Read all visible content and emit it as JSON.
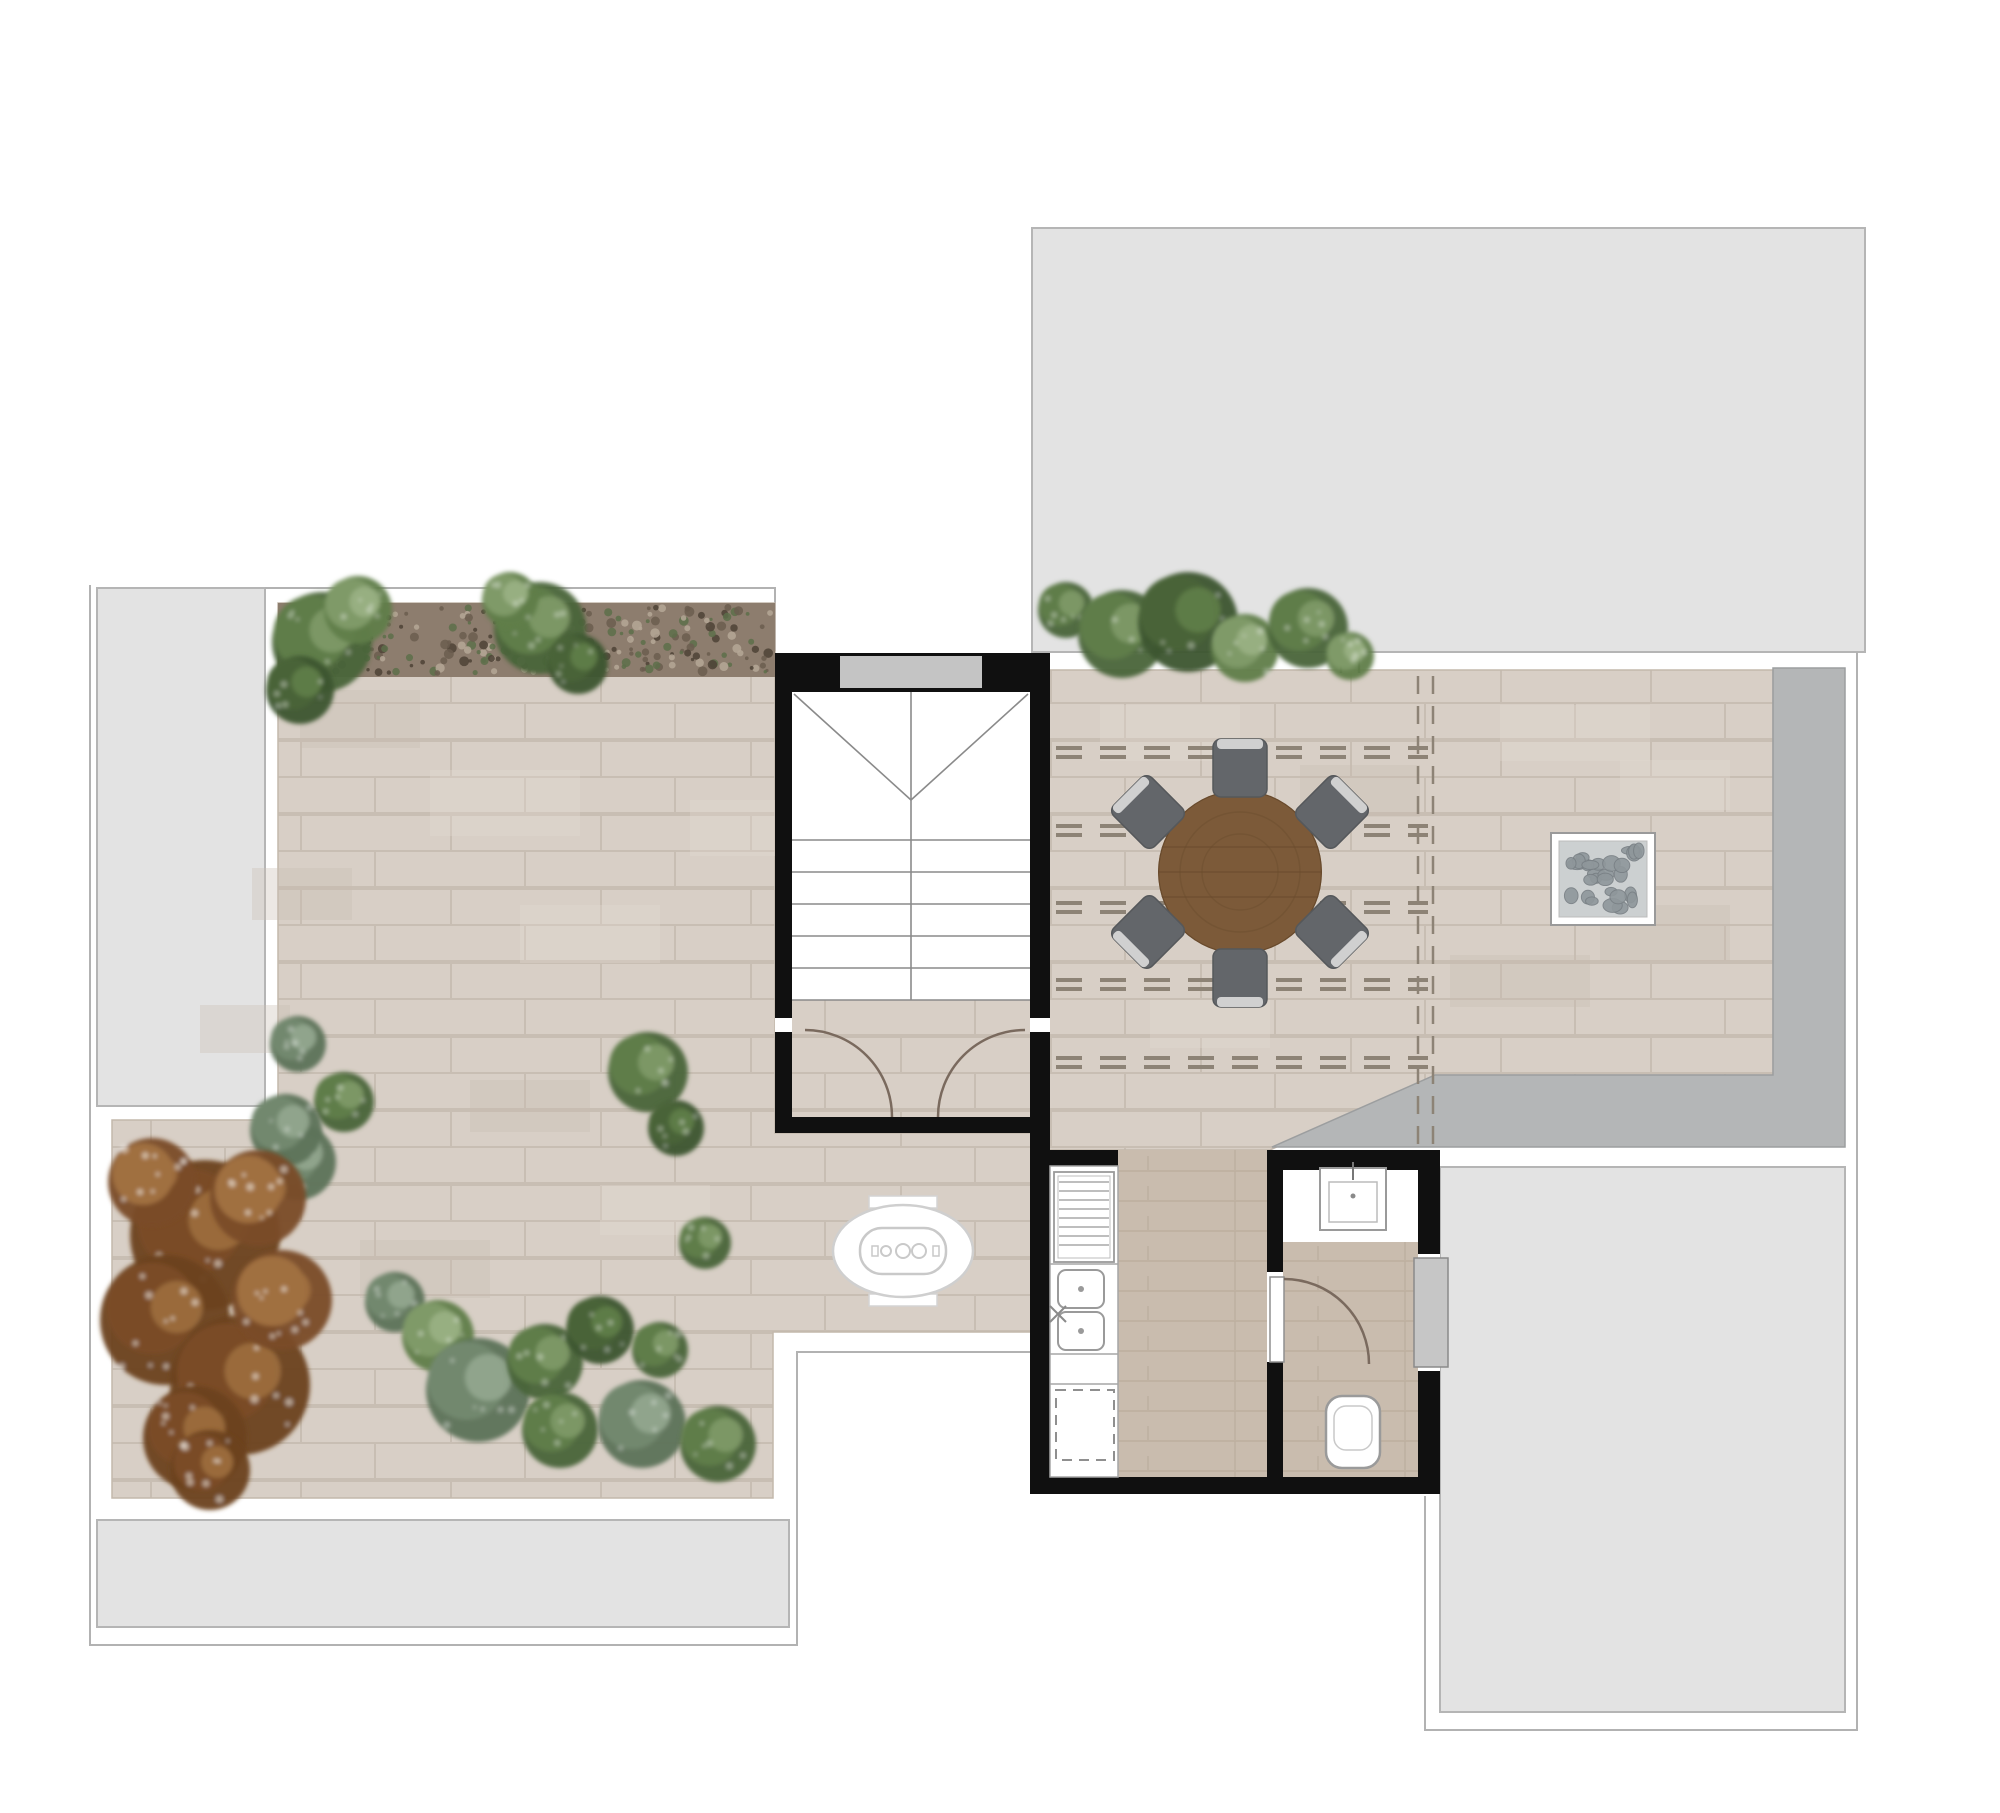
{
  "plan": {
    "kind": "rooftop-terrace-floor-plan",
    "width": 2000,
    "height": 1813,
    "rooms": [
      "left-terrace",
      "dining-terrace",
      "stairwell",
      "kitchen",
      "bathroom"
    ],
    "adjacent_roofs": [
      "roof-top-right",
      "roof-left",
      "roof-bottom-left",
      "roof-bottom-right"
    ]
  },
  "palette": {
    "page_bg": "#ffffff",
    "roof_gray": "#e3e3e3",
    "roof_border": "#b5b5b5",
    "outline": "#b2b2b2",
    "band_gray": "#b4b6b7",
    "band_border": "#9c9e9f",
    "paving": "#d8cfc6",
    "paving_joint": "#c3b8ac",
    "paving_light": "#e2dad2",
    "paving_dark": "#c9beb2",
    "interior_floor": "#c9bcae",
    "plank_line": "#b7a796",
    "wall_black": "#101010",
    "elevator_gray": "#c4c4c4",
    "stair_line": "#8a8a8a",
    "door_line": "#7a6a5e",
    "fixture_border": "#9a9a9a",
    "fixture_inner": "#bcbcbc",
    "window_gray": "#c6c6c6",
    "gravel_base": "#8d7d6e",
    "gravel_dark": "#4e4236",
    "gravel_light": "#b5a797",
    "gravel_green": "#5d6f4a",
    "pergola_dash": "#8d8376",
    "table_wood": "#7c5a39",
    "table_wood_dark": "#684a2c",
    "chair_gray": "#63666a",
    "chair_edge": "#55585b",
    "chair_light": "#d9d9d9",
    "pebble_bg": "#ccd0d1",
    "pebble": "#8f979b",
    "pebble_edge": "#798085",
    "bush_g": "#5f7d48",
    "bush_gd": "#4a6438",
    "bush_gl": "#7f9a68",
    "bush_sage": "#72886e",
    "tree_b": "#7a4c27",
    "tree_bl": "#a0703f"
  },
  "roofs": [
    {
      "name": "roof-top-right",
      "x": 1032,
      "y": 228,
      "w": 833,
      "h": 424
    },
    {
      "name": "roof-left",
      "x": 97,
      "y": 588,
      "w": 168,
      "h": 518
    },
    {
      "name": "roof-bottom-left",
      "x": 97,
      "y": 1520,
      "w": 692,
      "h": 107
    },
    {
      "name": "roof-bottom-right",
      "x": 1440,
      "y": 1167,
      "w": 405,
      "h": 545
    }
  ],
  "outlines": [
    {
      "name": "parapet-outline-top-left",
      "d": "M265,588 H775 V651"
    },
    {
      "name": "parapet-outline-lower-left",
      "d": "M90,585 V1645 H797 V1352 H1030"
    },
    {
      "name": "parapet-outline-right",
      "d": "M1857,652 V1730 H1425 V1496"
    }
  ],
  "paving": {
    "left_terrace_points": "278,603 775,603 775,1133 1032,1133 1032,1332 773,1332 773,1498 112,1498 112,1120 278,1120",
    "dining_terrace_points": "1048,670 1773,670 1773,1075 1435,1075 1270,1150 1048,1150",
    "dark_band_path": "M1773,668 H1845 V1147 H1272 L1435,1075 H1773 Z",
    "gravel_strip": {
      "x": 278,
      "y": 603,
      "w": 497,
      "h": 74
    },
    "mottles_left": [
      [
        300,
        690,
        120,
        58
      ],
      [
        430,
        770,
        150,
        66
      ],
      [
        252,
        868,
        100,
        52
      ],
      [
        520,
        905,
        140,
        58
      ],
      [
        360,
        1240,
        130,
        58
      ],
      [
        600,
        1185,
        110,
        50
      ],
      [
        200,
        1005,
        90,
        48
      ],
      [
        690,
        800,
        85,
        56
      ],
      [
        470,
        1080,
        120,
        52
      ]
    ],
    "mottles_dining": [
      [
        1100,
        705,
        140,
        56
      ],
      [
        1300,
        765,
        120,
        52
      ],
      [
        1500,
        705,
        150,
        56
      ],
      [
        1600,
        905,
        130,
        56
      ],
      [
        1150,
        1000,
        120,
        48
      ],
      [
        1450,
        955,
        140,
        52
      ],
      [
        1620,
        760,
        110,
        50
      ]
    ]
  },
  "pergola": {
    "x1": 1056,
    "x2": 1428,
    "rows_y": [
      748,
      826,
      903,
      980,
      1058
    ],
    "row_gap": 9,
    "dash": "26 18",
    "verticals_x": [
      1418,
      1433
    ],
    "v_y1": 676,
    "v_y2": 1146,
    "v_dash": "18 12"
  },
  "joint_symbol": {
    "name": "expansion-joint-symbol",
    "lines": [
      "M1341,651 V673",
      "M1359,651 V673",
      "M1341,662 H1359"
    ]
  },
  "stairwell": {
    "frame": [
      775,
      653,
      275,
      480
    ],
    "interior": [
      792,
      692,
      238,
      308
    ],
    "landing": [
      792,
      1000,
      238,
      117
    ],
    "elevator_band": [
      840,
      656,
      142,
      32
    ],
    "center_line": "M911,692 V1000",
    "diagonals": [
      "M794,694 L911,800",
      "M1028,694 L911,800"
    ],
    "treads_y": [
      840,
      872,
      904,
      936,
      968,
      1000
    ],
    "tread_x1": 792,
    "tread_x2": 1030,
    "jambs": [
      [
        775,
        1018,
        17,
        14
      ],
      [
        1030,
        1018,
        20,
        14
      ]
    ],
    "door_arcs": [
      "M805,1030 A87,87 0 0 1 892,1117",
      "M1025,1030 A87,87 0 0 0 938,1117"
    ]
  },
  "walls": [
    {
      "name": "wall-kitchen-left",
      "r": [
        1030,
        1133,
        20,
        361
      ]
    },
    {
      "name": "wall-kitchen-top-stub",
      "r": [
        1050,
        1150,
        68,
        18
      ]
    },
    {
      "name": "wall-partition-upper",
      "r": [
        1267,
        1150,
        16,
        122
      ]
    },
    {
      "name": "wall-partition-lower",
      "r": [
        1267,
        1362,
        16,
        115
      ]
    },
    {
      "name": "wall-bathroom-top",
      "r": [
        1283,
        1150,
        157,
        20
      ]
    },
    {
      "name": "wall-bathroom-right-upper",
      "r": [
        1418,
        1150,
        22,
        106
      ]
    },
    {
      "name": "wall-bathroom-right-lower",
      "r": [
        1418,
        1369,
        22,
        125
      ]
    },
    {
      "name": "wall-core-bottom",
      "r": [
        1030,
        1477,
        410,
        17
      ]
    }
  ],
  "kitchen": {
    "floor": [
      1118,
      1150,
      149,
      327
    ],
    "counter": [
      1050,
      1166,
      68,
      311
    ],
    "dividers": [
      "M1050,1264 H1118",
      "M1050,1354 H1118",
      "M1050,1384 H1118"
    ],
    "louver_appliance": {
      "outer": [
        1054,
        1172,
        60,
        90
      ],
      "inner": [
        1058,
        1176,
        52,
        82
      ],
      "lines_y1": 1182,
      "lines_y2": 1250,
      "lines_step": 9,
      "x1": 1059,
      "x2": 1109
    },
    "sink_units": [
      [
        1058,
        1270,
        46,
        38
      ],
      [
        1058,
        1312,
        46,
        38
      ]
    ],
    "sink_dots": [
      [
        1081,
        1289
      ],
      [
        1081,
        1331
      ]
    ],
    "faucet_cross": [
      "M1050,1322 L1066,1306",
      "M1050,1306 L1066,1322"
    ],
    "dishwasher_dashed": [
      1056,
      1390,
      58,
      70
    ]
  },
  "bathroom": {
    "floor": [
      1283,
      1242,
      135,
      235
    ],
    "white_zone": [
      1283,
      1170,
      135,
      72
    ],
    "sink_outer": [
      1320,
      1168,
      66,
      62
    ],
    "sink_inner": [
      1329,
      1182,
      48,
      40
    ],
    "sink_faucet": "M1353,1162 V1180",
    "sink_dot": [
      1353,
      1196
    ],
    "toilet": [
      1326,
      1396,
      54,
      72
    ],
    "toilet_inner": [
      1334,
      1406,
      38,
      44
    ],
    "door_leaf": [
      1270,
      1277,
      14,
      85
    ],
    "door_arc": "M1284,1279 A85,85 0 0 1 1369,1364",
    "window_gap": [
      1418,
      1254,
      22,
      117
    ],
    "window_pane": [
      1414,
      1258,
      34,
      109
    ]
  },
  "furniture": {
    "dining_table": {
      "cx": 1240,
      "cy": 872,
      "r": 82,
      "ring_r": [
        60,
        38
      ],
      "plank_y": [
        -25,
        0,
        25
      ]
    },
    "chairs": [
      {
        "x": 1240,
        "y": 768,
        "rot": 0
      },
      {
        "x": 1148,
        "y": 812,
        "rot": -45
      },
      {
        "x": 1148,
        "y": 932,
        "rot": -135
      },
      {
        "x": 1240,
        "y": 978,
        "rot": 180
      },
      {
        "x": 1332,
        "y": 932,
        "rot": 135
      },
      {
        "x": 1332,
        "y": 812,
        "rot": 45
      }
    ],
    "bbq_oval": {
      "cx": 903,
      "cy": 1251,
      "rx": 70,
      "ry": 46,
      "tabs": [
        [
          869,
          1196,
          68,
          12
        ],
        [
          869,
          1294,
          68,
          12
        ]
      ],
      "panel": [
        860,
        1228,
        86,
        46
      ],
      "knobs": [
        [
          886,
          1251,
          5
        ],
        [
          903,
          1251,
          7
        ],
        [
          919,
          1251,
          7
        ]
      ],
      "end_caps": [
        [
          872,
          1246,
          6,
          10
        ],
        [
          933,
          1246,
          6,
          10
        ]
      ]
    },
    "pebble_square": {
      "outer": [
        1551,
        833,
        104,
        92
      ],
      "inner": [
        1559,
        841,
        88,
        76
      ]
    }
  },
  "vegetation": {
    "bushes": [
      [
        322,
        642,
        50,
        "g"
      ],
      [
        358,
        610,
        34,
        "gl"
      ],
      [
        300,
        690,
        34,
        "gd"
      ],
      [
        540,
        628,
        46,
        "g"
      ],
      [
        578,
        664,
        30,
        "gd"
      ],
      [
        510,
        600,
        28,
        "gl"
      ],
      [
        1066,
        610,
        28,
        "g"
      ],
      [
        1122,
        634,
        44,
        "g"
      ],
      [
        1188,
        622,
        50,
        "gd"
      ],
      [
        1245,
        648,
        34,
        "gl"
      ],
      [
        1308,
        628,
        40,
        "g"
      ],
      [
        1350,
        656,
        24,
        "gl"
      ],
      [
        298,
        1044,
        28,
        "sage"
      ],
      [
        344,
        1102,
        30,
        "g"
      ],
      [
        298,
        1162,
        38,
        "sage"
      ],
      [
        286,
        1130,
        36,
        "sage"
      ],
      [
        648,
        1072,
        40,
        "g"
      ],
      [
        676,
        1128,
        28,
        "gd"
      ],
      [
        705,
        1243,
        26,
        "g"
      ],
      [
        395,
        1302,
        30,
        "sage"
      ],
      [
        438,
        1336,
        36,
        "gl"
      ],
      [
        478,
        1390,
        52,
        "sage"
      ],
      [
        545,
        1362,
        38,
        "g"
      ],
      [
        600,
        1330,
        34,
        "gd"
      ],
      [
        560,
        1430,
        38,
        "g"
      ],
      [
        642,
        1424,
        44,
        "sage"
      ],
      [
        718,
        1444,
        38,
        "g"
      ],
      [
        660,
        1350,
        28,
        "g"
      ]
    ],
    "tree_blobs": [
      [
        205,
        1235,
        75,
        "b"
      ],
      [
        165,
        1320,
        65,
        "b"
      ],
      [
        240,
        1385,
        70,
        "b"
      ],
      [
        195,
        1438,
        52,
        "b"
      ],
      [
        258,
        1198,
        48,
        "bl"
      ],
      [
        152,
        1182,
        44,
        "bl"
      ],
      [
        282,
        1300,
        50,
        "bl"
      ],
      [
        210,
        1470,
        40,
        "b"
      ]
    ]
  }
}
